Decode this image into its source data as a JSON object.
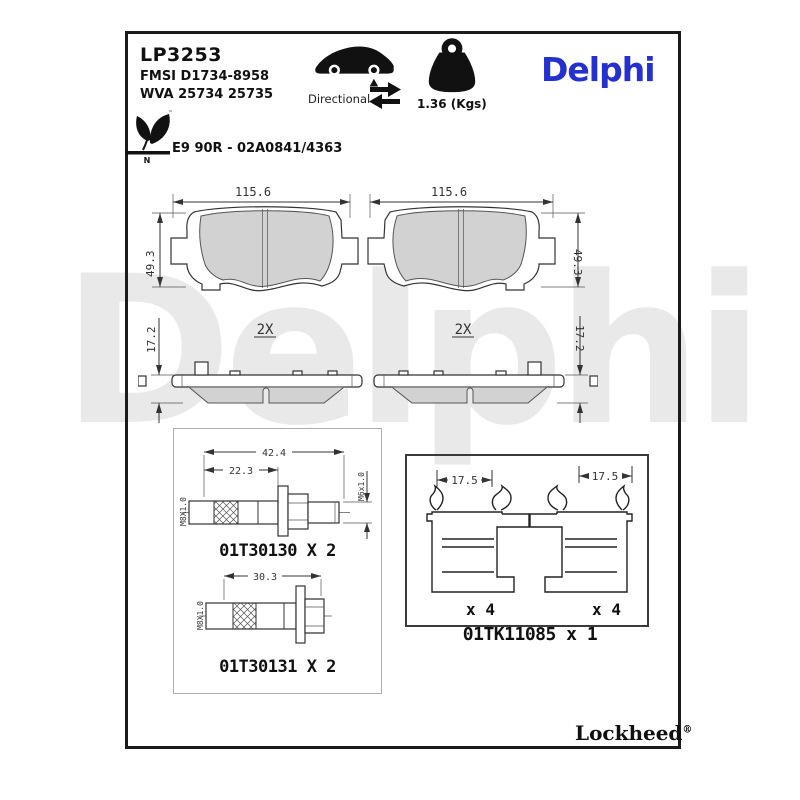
{
  "watermark": "Delphi",
  "header": {
    "part_number": "LP3253",
    "fmsi": "FMSI D1734-8958",
    "wva": "WVA 25734 25735",
    "directional_label": "Directional",
    "weight": "1.36 (Kgs)",
    "brand": "Delphi",
    "approval": "E9 90R - 02A0841/4363",
    "eco_mark_letter": "N",
    "trademark": "™"
  },
  "colors": {
    "brand_blue": "#2531cf",
    "pad_fill": "#d2d2d2",
    "watermark_gray": "#e9e9e9"
  },
  "pad_views": {
    "front_left": {
      "width_dim": "115.6",
      "height_dim": "49.3"
    },
    "front_right": {
      "width_dim": "115.6",
      "height_dim": "49.3"
    },
    "side_left": {
      "qty": "2X",
      "thickness_dim": "17.2"
    },
    "side_right": {
      "qty": "2X",
      "thickness_dim": "17.2"
    }
  },
  "hardware": {
    "bolt1": {
      "length_dim": "42.4",
      "shoulder_dim": "22.3",
      "thread_left": "M8X1.0",
      "thread_right": "M6x1.0",
      "label": "01T30130 X 2"
    },
    "bolt2": {
      "length_dim": "30.3",
      "thread_left": "M8X1.0",
      "label": "01T30131 X 2"
    },
    "clips": {
      "left_dim": "17.5",
      "right_dim": "17.5",
      "left_qty": "x 4",
      "right_qty": "x 4",
      "label": "01TK11085 x 1"
    }
  },
  "footer": {
    "brand": "Lockheed",
    "registered": "®"
  }
}
